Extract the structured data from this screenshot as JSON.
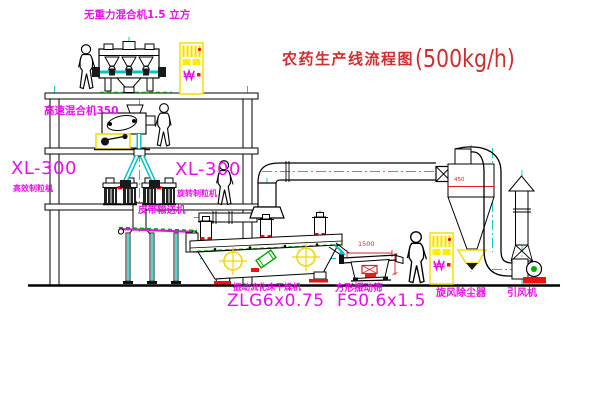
{
  "title": {
    "name": "农药生产线流程图",
    "capacity": "(500kg/h)"
  },
  "labels": {
    "gravity_mixer": "无重力混合机1.5 立方",
    "high_speed_mixer": "高速混合机350",
    "granulator_left_model": "XL-300",
    "granulator_left_name": "高效制粒机",
    "granulator_center_model": "XL-300",
    "granulator_center_name": "旋转制粒机",
    "belt_conveyor": "皮带输送机",
    "dryer_name": "振动流化床干燥机",
    "dryer_model": "ZLG6x0.75",
    "screen_name": "方形振动筛",
    "screen_model": "FS0.6x1.5",
    "cyclone": "旋风除尘器",
    "fan": "引风机"
  },
  "dimensions": {
    "screen_length": "1500",
    "cyclone_outlet": "450"
  },
  "colors": {
    "label_magenta": "#e810e8",
    "title_red": "#cf2f2f",
    "pipe_cyan": "#00c4c4",
    "cabinet_yellow": "#f2e000",
    "accent_red": "#ee1111",
    "accent_green": "#00a800",
    "line_black": "#000000"
  }
}
